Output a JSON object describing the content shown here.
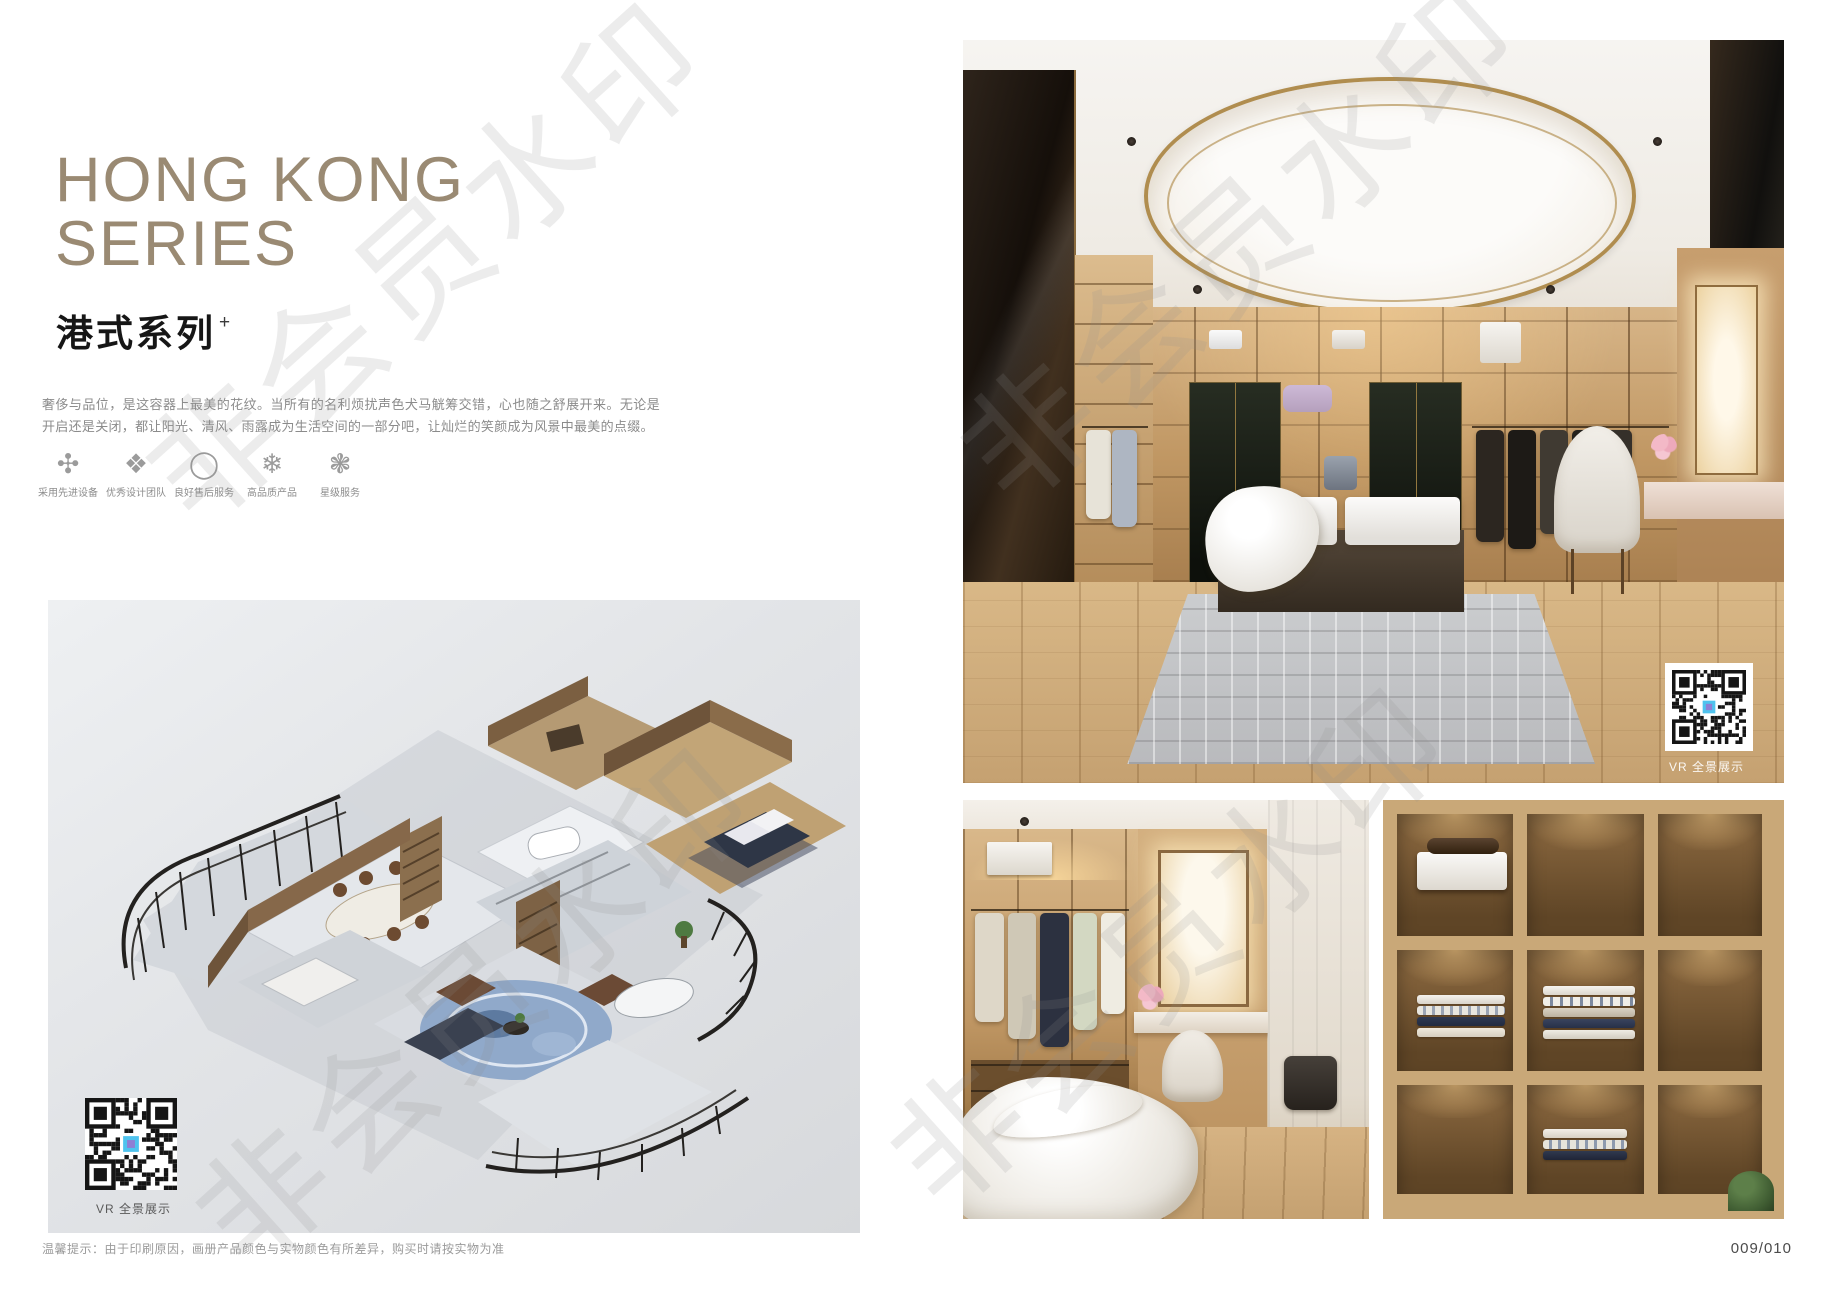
{
  "theme": {
    "title_color": "#9a8a73",
    "floorplan_bg": "#e4e6e9",
    "page_bg": "#ffffff"
  },
  "watermark": {
    "text": "非会员水印"
  },
  "header": {
    "title_line1": "HONG KONG",
    "title_line2": "SERIES",
    "subtitle": "港式系列",
    "subtitle_mark": "+",
    "description": "奢侈与品位，是这容器上最美的花纹。当所有的名利烦扰声色犬马觥筹交错，心也随之舒展开来。无论是开启还是关闭，都让阳光、清风、雨露成为生活空间的一部分吧，让灿烂的笑颜成为风景中最美的点缀。"
  },
  "features": [
    {
      "icon": "pinwheel-icon",
      "glyph": "✣",
      "label": "采用先进设备"
    },
    {
      "icon": "rosette-icon",
      "glyph": "❖",
      "label": "优秀设计团队"
    },
    {
      "icon": "ring-icon",
      "glyph": "◯",
      "label": "良好售后服务"
    },
    {
      "icon": "snowflake-icon",
      "glyph": "❄",
      "label": "高品质产品"
    },
    {
      "icon": "star-flower-icon",
      "glyph": "❃",
      "label": "星级服务"
    }
  ],
  "floorplan": {
    "qr_caption": "VR 全景展示"
  },
  "main_photo": {
    "qr_caption": "VR 全景展示"
  },
  "footer": {
    "tip": "温馨提示：由于印刷原因，画册产品颜色与实物颜色有所差异，购买时请按实物为准",
    "page_number": "009/010"
  }
}
